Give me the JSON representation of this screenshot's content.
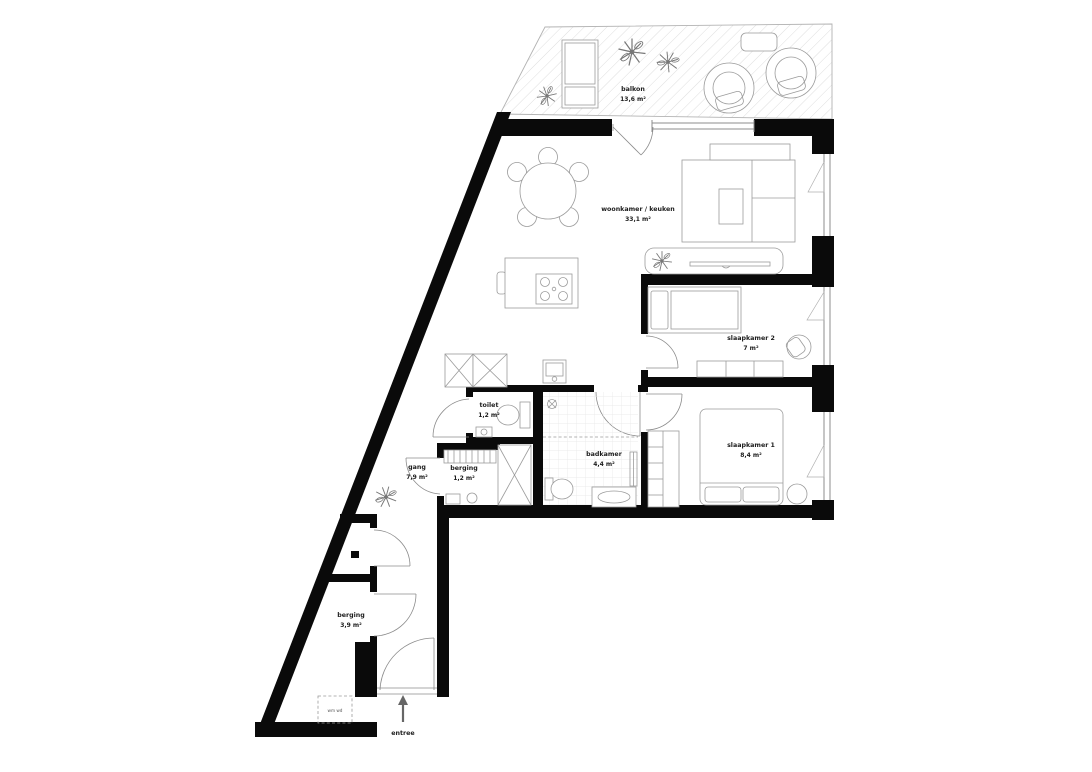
{
  "plan": {
    "rooms": {
      "balkon": {
        "name": "balkon",
        "area": "13,6 m²"
      },
      "woonkamer": {
        "name": "woonkamer / keuken",
        "area": "33,1 m²"
      },
      "slaapkamer2": {
        "name": "slaapkamer 2",
        "area": "7 m²"
      },
      "slaapkamer1": {
        "name": "slaapkamer 1",
        "area": "8,4 m²"
      },
      "toilet": {
        "name": "toilet",
        "area": "1,2 m²"
      },
      "badkamer": {
        "name": "badkamer",
        "area": "4,4 m²"
      },
      "gang": {
        "name": "gang",
        "area": "7,9 m²"
      },
      "berging_klein": {
        "name": "berging",
        "area": "1,2 m²"
      },
      "berging_groot": {
        "name": "berging",
        "area": "3,9 m²"
      }
    },
    "entrance_label": "entree",
    "laundry_label": "wm wd",
    "colors": {
      "wall": "#0a0a0a",
      "furniture_line": "#9b9b9b",
      "balcony_hatch": "#dedede",
      "label_text": "#1c1c1c"
    }
  }
}
